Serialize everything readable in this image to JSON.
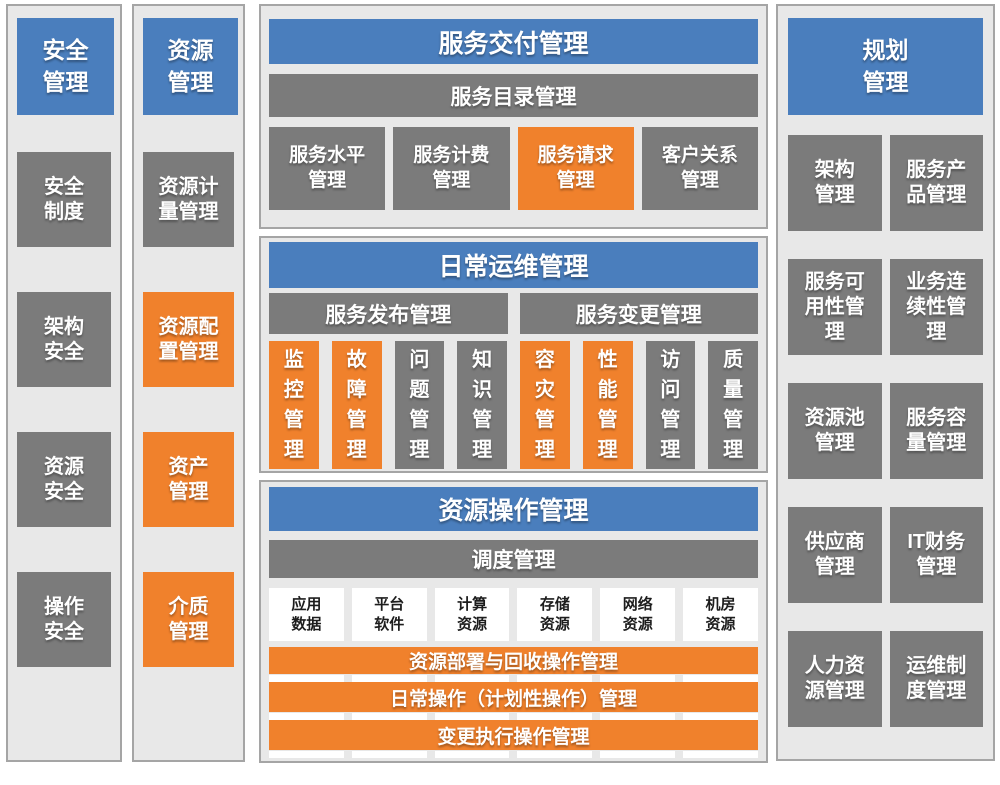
{
  "colors": {
    "header_blue": "#4A7EBD",
    "box_gray": "#7B7B7B",
    "box_orange": "#F0812C",
    "panel_bg": "#E8E8E8",
    "panel_border": "#A5A5A5",
    "white_box_bg": "#FFFFFF",
    "white_box_text": "#1D1D1D"
  },
  "security": {
    "title": "安全\n管理",
    "items": [
      {
        "label": "安全\n制度",
        "color": "gray"
      },
      {
        "label": "架构\n安全",
        "color": "gray"
      },
      {
        "label": "资源\n安全",
        "color": "gray"
      },
      {
        "label": "操作\n安全",
        "color": "gray"
      }
    ]
  },
  "resource": {
    "title": "资源\n管理",
    "items": [
      {
        "label": "资源计\n量管理",
        "color": "gray"
      },
      {
        "label": "资源配\n置管理",
        "color": "orange"
      },
      {
        "label": "资产\n管理",
        "color": "orange"
      },
      {
        "label": "介质\n管理",
        "color": "orange"
      }
    ]
  },
  "service_delivery": {
    "title": "服务交付管理",
    "catalog_bar": "服务目录管理",
    "items": [
      {
        "label": "服务水平\n管理",
        "color": "gray"
      },
      {
        "label": "服务计费\n管理",
        "color": "gray"
      },
      {
        "label": "服务请求\n管理",
        "color": "orange"
      },
      {
        "label": "客户关系\n管理",
        "color": "gray"
      }
    ]
  },
  "daily_ops": {
    "title": "日常运维管理",
    "release_bar": "服务发布管理",
    "change_bar": "服务变更管理",
    "items": [
      {
        "label": "监控管理",
        "color": "orange"
      },
      {
        "label": "故障管理",
        "color": "orange"
      },
      {
        "label": "问题管理",
        "color": "gray"
      },
      {
        "label": "知识管理",
        "color": "gray"
      },
      {
        "label": "容灾管理",
        "color": "orange"
      },
      {
        "label": "性能管理",
        "color": "orange"
      },
      {
        "label": "访问管理",
        "color": "gray"
      },
      {
        "label": "质量管理",
        "color": "gray"
      }
    ]
  },
  "resource_ops": {
    "title": "资源操作管理",
    "schedule_bar": "调度管理",
    "resources": [
      "应用\n数据",
      "平台\n软件",
      "计算\n资源",
      "存储\n资源",
      "网络\n资源",
      "机房\n资源"
    ],
    "op_bars": [
      "资源部署与回收操作管理",
      "日常操作（计划性操作）管理",
      "变更执行操作管理"
    ]
  },
  "planning": {
    "title": "规划\n管理",
    "items": [
      "架构\n管理",
      "服务产\n品管理",
      "服务可\n用性管\n理",
      "业务连\n续性管\n理",
      "资源池\n管理",
      "服务容\n量管理",
      "供应商\n管理",
      "IT财务\n管理",
      "人力资\n源管理",
      "运维制\n度管理"
    ]
  }
}
